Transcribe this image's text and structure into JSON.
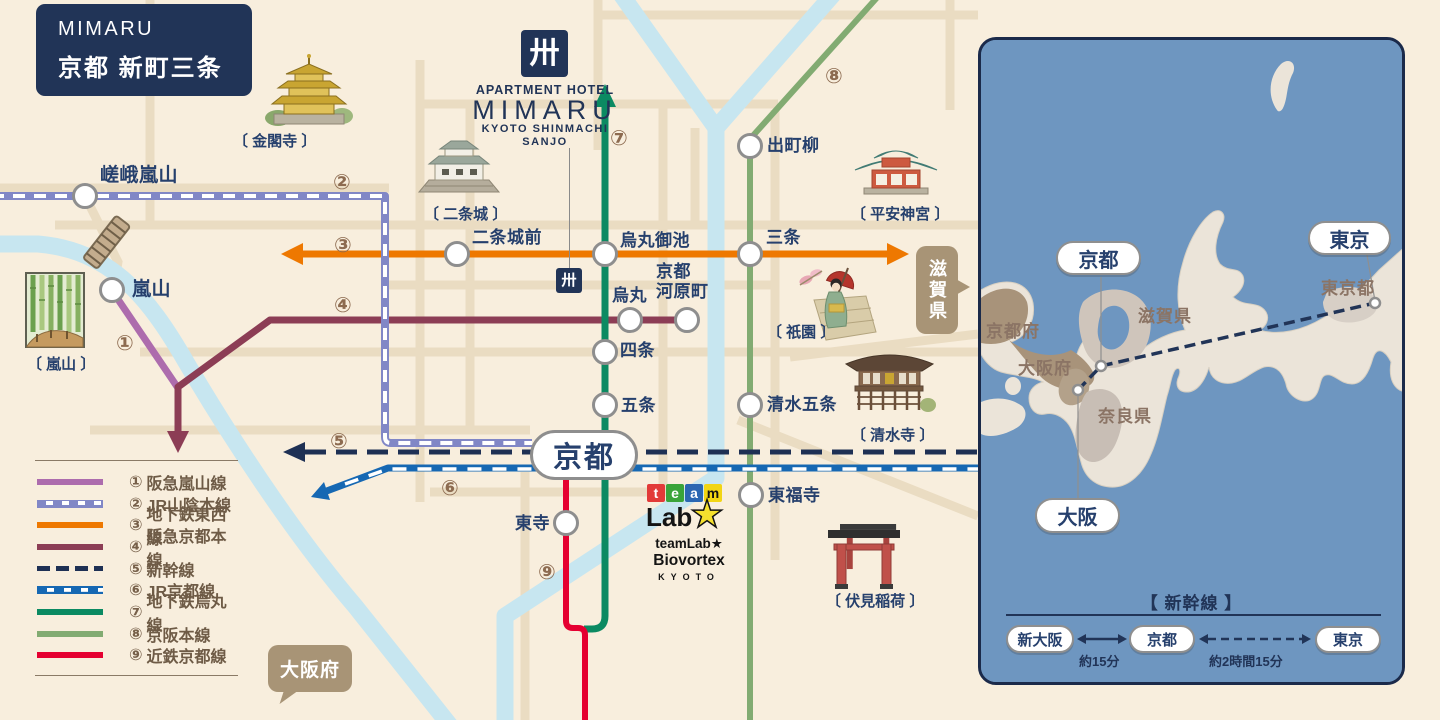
{
  "header": {
    "brand": "MIMARU",
    "name": "京都 新町三条"
  },
  "hotel": {
    "mark": "卅",
    "tagline": "APARTMENT HOTEL",
    "brand": "MIMARU",
    "sub1": "KYOTO SHINMACHI",
    "sub2": "SANJO",
    "map_mark": "卅"
  },
  "stations": {
    "saga_arashiyama": "嵯峨嵐山",
    "arashiyama": "嵐山",
    "nijojo_mae": "二条城前",
    "karasuma_oike": "烏丸御池",
    "sanjo": "三条",
    "demachiyanagi": "出町柳",
    "karasuma": "烏丸",
    "kyoto_kawaramachi": "京都\n河原町",
    "shijo": "四条",
    "gojo": "五条",
    "kiyomizu_gojo": "清水五条",
    "kyoto": "京都",
    "tofukuji": "東福寺",
    "toji": "東寺"
  },
  "landmarks": {
    "kinkakuji": "〔 金閣寺 〕",
    "nijojo": "〔 二条城 〕",
    "heian_jingu": "〔 平安神宮 〕",
    "arashiyama": "〔 嵐山 〕",
    "gion": "〔 祇園 〕",
    "kiyomizudera": "〔 清水寺 〕",
    "fushimi_inari": "〔 伏見稲荷 〕"
  },
  "bubbles": {
    "shiga": "滋賀県",
    "osaka_fu": "大阪府"
  },
  "badges": {
    "n1": "①",
    "n2": "②",
    "n3": "③",
    "n4": "④",
    "n5": "⑤",
    "n6": "⑥",
    "n7": "⑦",
    "n8": "⑧",
    "n9": "⑨"
  },
  "legend": {
    "items": [
      {
        "num": "①",
        "label": "阪急嵐山線"
      },
      {
        "num": "②",
        "label": "JR山陰本線"
      },
      {
        "num": "③",
        "label": "地下鉄東西線"
      },
      {
        "num": "④",
        "label": "阪急京都本線"
      },
      {
        "num": "⑤",
        "label": "新幹線"
      },
      {
        "num": "⑥",
        "label": "JR京都線"
      },
      {
        "num": "⑦",
        "label": "地下鉄烏丸線"
      },
      {
        "num": "⑧",
        "label": "京阪本線"
      },
      {
        "num": "⑨",
        "label": "近鉄京都線"
      }
    ]
  },
  "teamlab": {
    "t1": "t",
    "t2": "e",
    "t3": "a",
    "t4": "m",
    "lab": "Lab",
    "star": "★",
    "sub1": "teamLab★",
    "sub2": "Biovortex",
    "sub3": "KYOTO"
  },
  "inset": {
    "cities": {
      "kyoto": "京都",
      "tokyo": "東京",
      "osaka": "大阪"
    },
    "regions": {
      "kyoto_fu": "京都府",
      "shiga": "滋賀県",
      "osaka_fu": "大阪府",
      "nara": "奈良県",
      "tokyo_to": "東京都"
    },
    "diagram": {
      "heading": "【 新幹線 】",
      "stop1": "新大阪",
      "stop2": "京都",
      "stop3": "東京",
      "dur1": "約15分",
      "dur2": "約2時間15分"
    }
  },
  "colors": {
    "line1": "#ad6cad",
    "line2": "#8187c6",
    "line3": "#ee7800",
    "line4": "#8c3d55",
    "line5": "#1e3054",
    "line6": "#1668b3",
    "line7": "#0b8a62",
    "line8": "#82ab72",
    "line9": "#e50031",
    "navy": "#213457",
    "bubble_brown": "#a89476",
    "river": "#c7e6f0",
    "road": "#eadcc2",
    "sea": "#6e96c0",
    "land": "#ebe4d9"
  }
}
